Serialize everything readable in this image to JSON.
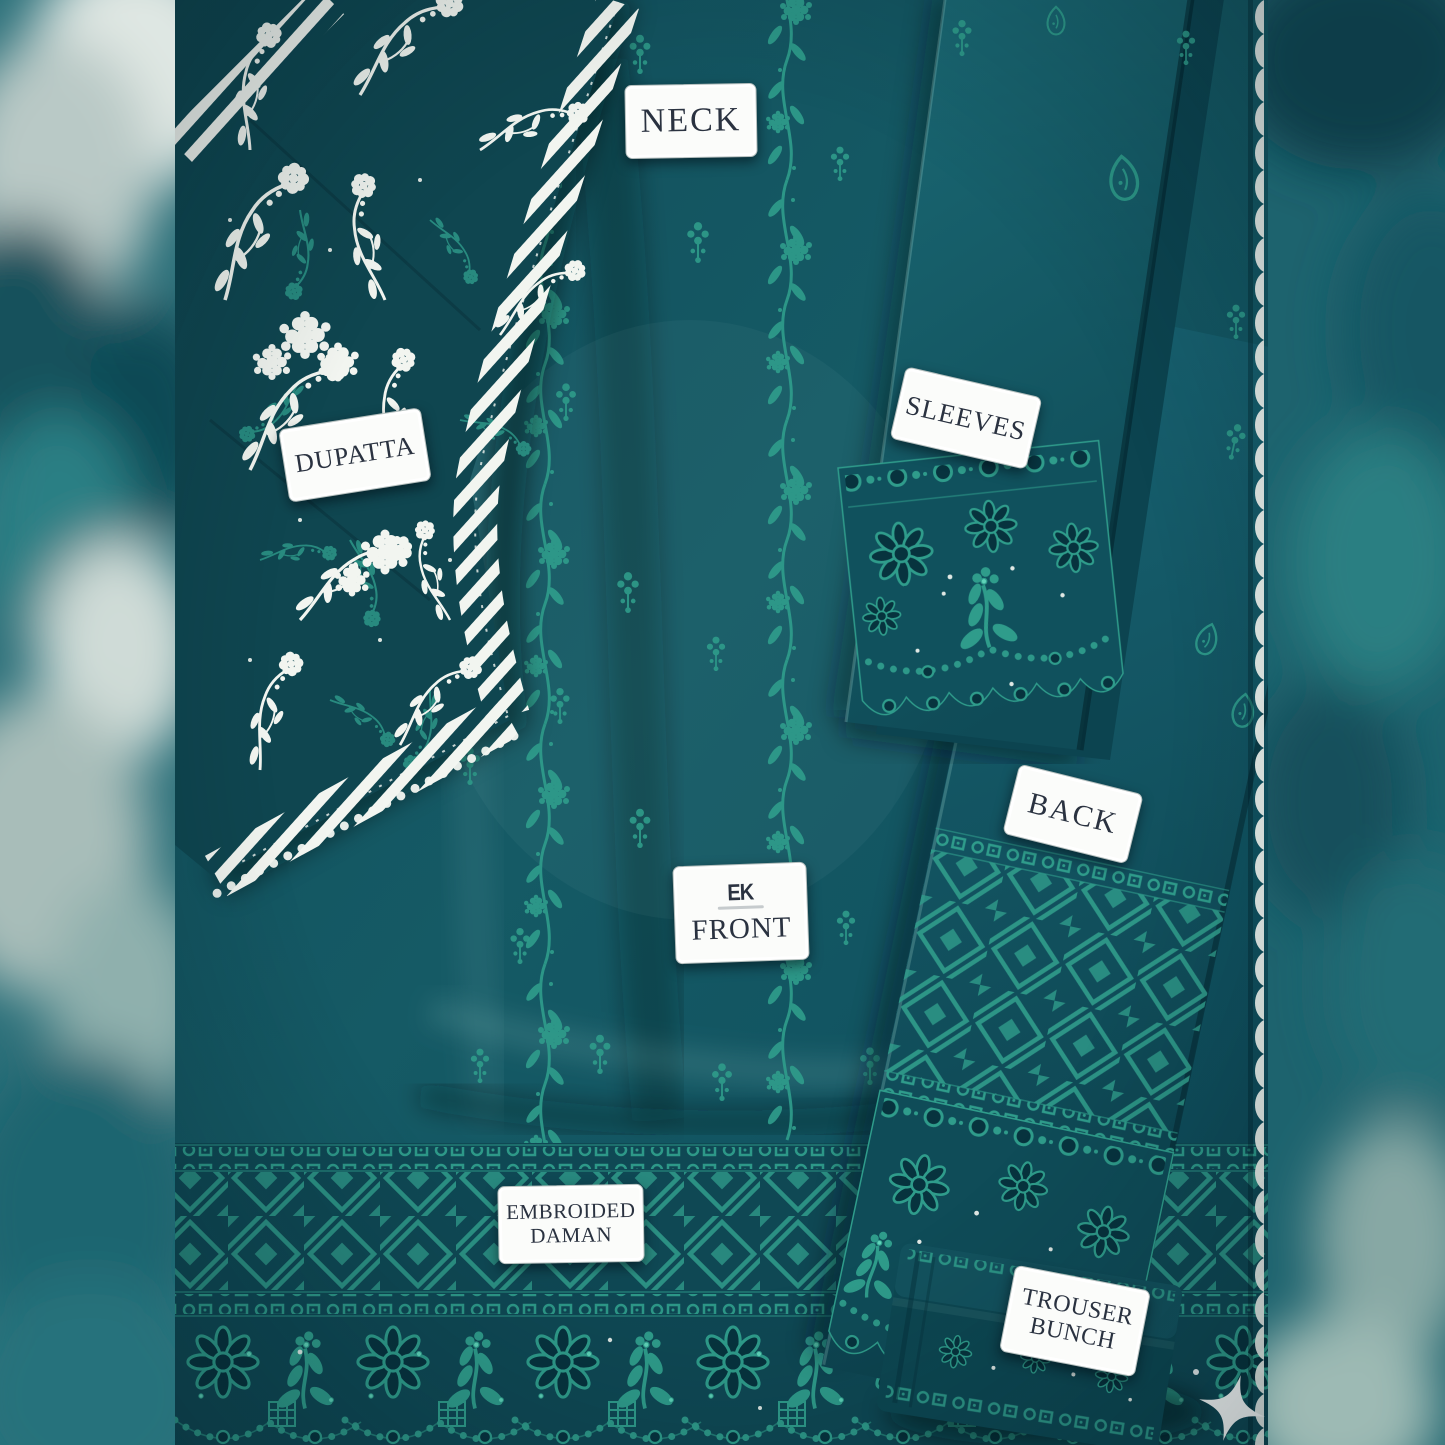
{
  "labels": {
    "neck": "NECK",
    "dupatta": "DUPATTA",
    "sleeves": "SLEEVES",
    "back": "BACK",
    "front": "FRONT",
    "front_logo": "EK",
    "embroided_daman_line1": "EMBROIDED",
    "embroided_daman_line2": "DAMAN",
    "trouser_line1": "TROUSER",
    "trouser_line2": "BUNCH"
  },
  "colors": {
    "teal-base": "#14525e",
    "teal-deep": "#07333e",
    "teal-dark": "#0d4551",
    "teal-light": "#2f9c8b",
    "teal-mint": "#5fd3b8",
    "lace-white": "#f2f5f0",
    "label-bg": "#fbfcfa",
    "label-text": "#2a3240",
    "blur-teal": "#27707a"
  }
}
